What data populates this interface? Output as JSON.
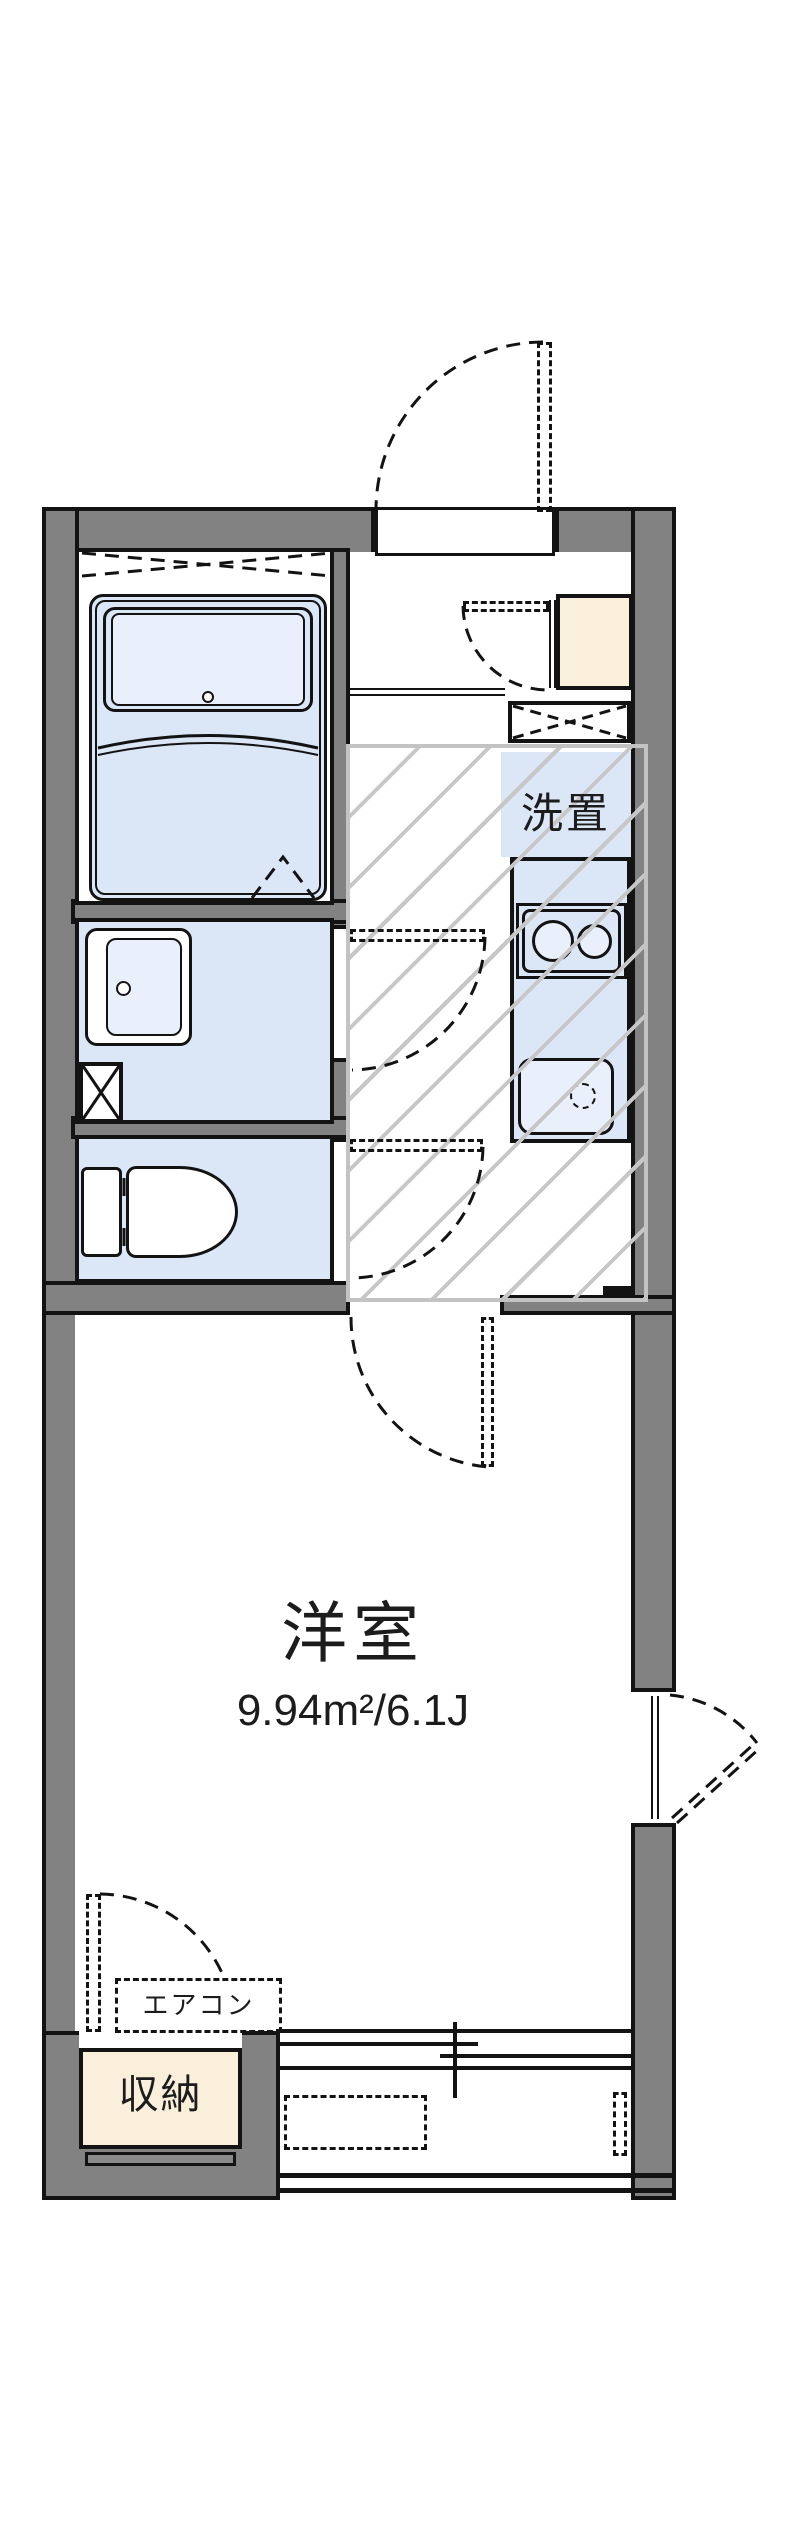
{
  "plan": {
    "labels": {
      "laundry": "洗置",
      "main_room": "洋室",
      "main_room_area": "9.94m²/6.1J",
      "aircon": "エアコン",
      "storage": "収納"
    },
    "colors": {
      "wall": "#828282",
      "outline": "#131313",
      "fixture_fill": "#dbe6f7",
      "fixture_fill_light": "#e9f0fb",
      "cabinet_fill": "#f9efdb",
      "hatch_line": "#c7c7c7"
    }
  }
}
